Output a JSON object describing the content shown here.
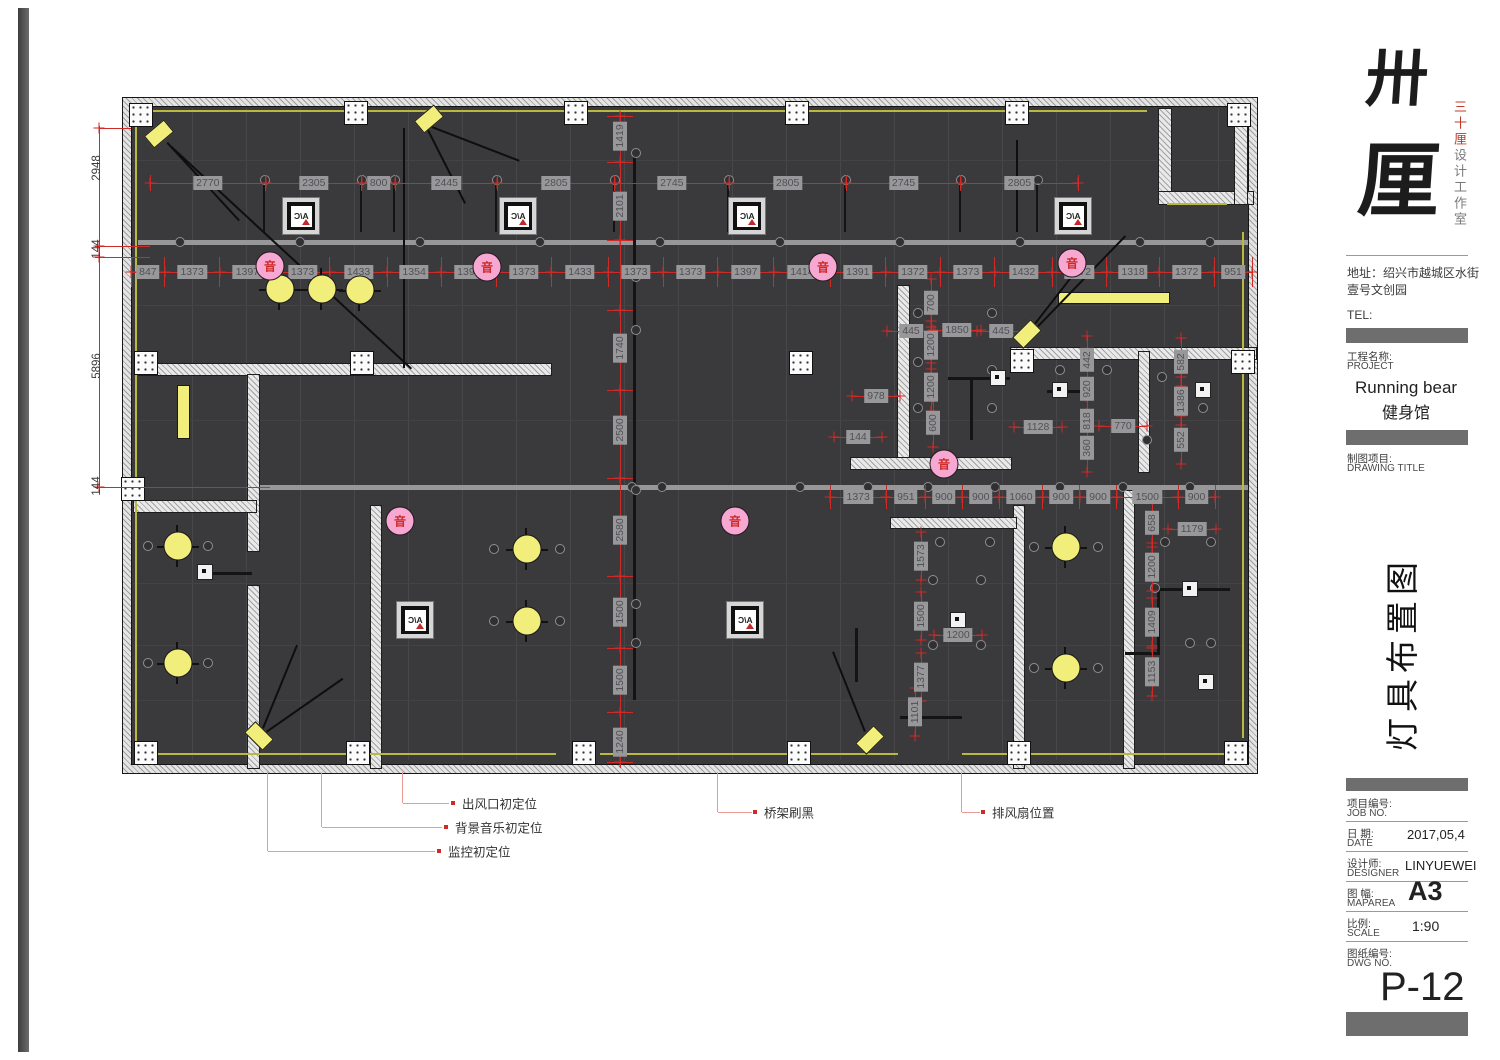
{
  "logo": {
    "char1": "卅",
    "char2": "厘",
    "side_red": "三十厘",
    "side_gray": "设计工作室"
  },
  "contact": {
    "address_line1": "地址：绍兴市越城区水街",
    "address_line2": "壹号文创园",
    "tel": "TEL:"
  },
  "project": {
    "label_cn": "工程名称:",
    "label_en": "PROJECT",
    "name_en": "Running bear",
    "name_cn": "健身馆"
  },
  "drawing_title": {
    "label_cn": "制图项目:",
    "label_en": "DRAWING TITLE",
    "vertical": "灯具布置图"
  },
  "fields": {
    "job_cn": "项目编号:",
    "job_en": "JOB NO.",
    "date_cn": "日  期:",
    "date_en": "DATE",
    "date_val": "2017,05,4",
    "designer_cn": "设计师:",
    "designer_en": "DESIGNER",
    "designer_val": "LINYUEWEI",
    "area_cn": "图  幅:",
    "area_en": "MAPAREA",
    "area_val": "A3",
    "scale_cn": "比例:",
    "scale_en": "SCALE",
    "scale_val": "1:90",
    "dwg_cn": "图纸编号:",
    "dwg_en": "DWG NO.",
    "dwg_val": "P-12"
  },
  "legend": {
    "items": [
      "出风口初定位",
      "背景音乐初定位",
      "监控初定位",
      "桥架刷黑",
      "排风扇位置"
    ]
  },
  "plan": {
    "ac_label": "A/C",
    "sound_label": "音",
    "dims": {
      "top": [
        "2770",
        "2305",
        "800",
        "2445",
        "2805",
        "2745",
        "2805",
        "2745",
        "2805"
      ],
      "mid": [
        "847",
        "1373",
        "1397",
        "1373",
        "1433",
        "1354",
        "1391",
        "1373",
        "1433",
        "1373",
        "1373",
        "1397",
        "1414",
        "1391",
        "1372",
        "1373",
        "1432",
        "1372",
        "1318",
        "1372",
        "951"
      ],
      "bottom_right": [
        "1373",
        "951",
        "900",
        "900",
        "1060",
        "900",
        "900",
        "1500",
        "900"
      ],
      "center_vertical": [
        "1419",
        "2101",
        "1740",
        "2500",
        "2580",
        "1500",
        "1500",
        "1240"
      ],
      "left_vertical": [
        "2948",
        "144",
        "5896",
        "144"
      ],
      "misc": [
        {
          "v": "700",
          "x": 931,
          "y": 303,
          "o": "v"
        },
        {
          "v": "445",
          "x": 911,
          "y": 331,
          "o": "h"
        },
        {
          "v": "1850",
          "x": 957,
          "y": 330,
          "o": "h"
        },
        {
          "v": "445",
          "x": 1001,
          "y": 331,
          "o": "h"
        },
        {
          "v": "1200",
          "x": 931,
          "y": 345,
          "o": "v"
        },
        {
          "v": "1200",
          "x": 931,
          "y": 387,
          "o": "v"
        },
        {
          "v": "600",
          "x": 933,
          "y": 423,
          "o": "v"
        },
        {
          "v": "978",
          "x": 876,
          "y": 396,
          "o": "h"
        },
        {
          "v": "144",
          "x": 858,
          "y": 437,
          "o": "h"
        },
        {
          "v": "1128",
          "x": 1038,
          "y": 427,
          "o": "h"
        },
        {
          "v": "770",
          "x": 1123,
          "y": 426,
          "o": "h"
        },
        {
          "v": "442",
          "x": 1087,
          "y": 360,
          "o": "v"
        },
        {
          "v": "920",
          "x": 1087,
          "y": 389,
          "o": "v"
        },
        {
          "v": "818",
          "x": 1087,
          "y": 421,
          "o": "v"
        },
        {
          "v": "360",
          "x": 1087,
          "y": 448,
          "o": "v"
        },
        {
          "v": "582",
          "x": 1181,
          "y": 362,
          "o": "v"
        },
        {
          "v": "1386",
          "x": 1181,
          "y": 401,
          "o": "v"
        },
        {
          "v": "552",
          "x": 1181,
          "y": 440,
          "o": "v"
        },
        {
          "v": "1573",
          "x": 921,
          "y": 556,
          "o": "v"
        },
        {
          "v": "1500",
          "x": 921,
          "y": 616,
          "o": "v"
        },
        {
          "v": "1377",
          "x": 921,
          "y": 677,
          "o": "v"
        },
        {
          "v": "1200",
          "x": 958,
          "y": 635,
          "o": "h"
        },
        {
          "v": "658",
          "x": 1152,
          "y": 523,
          "o": "v"
        },
        {
          "v": "1179",
          "x": 1192,
          "y": 529,
          "o": "h"
        },
        {
          "v": "1200",
          "x": 1152,
          "y": 567,
          "o": "v"
        },
        {
          "v": "1409",
          "x": 1152,
          "y": 622,
          "o": "v"
        },
        {
          "v": "1153",
          "x": 1152,
          "y": 672,
          "o": "v"
        },
        {
          "v": "1101",
          "x": 915,
          "y": 712,
          "o": "v"
        }
      ]
    }
  },
  "colors": {
    "red": "#cf2b26",
    "tag_bg": "#98989b",
    "plan_bg": "#3a3a3c",
    "yellow": "#f1ee7b",
    "pink": "#f6a8d3",
    "bar": "#6e6e6e"
  }
}
